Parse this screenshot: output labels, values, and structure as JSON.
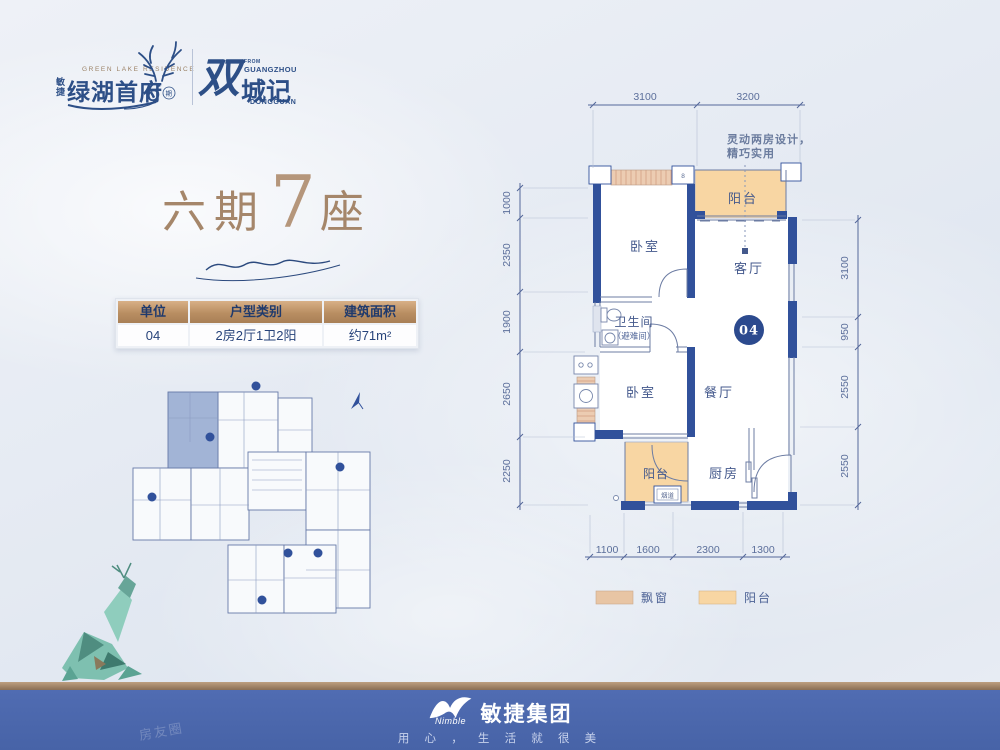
{
  "brand": {
    "company": "敏捷",
    "name": "绿湖首府",
    "name_en": "GREEN LAKE RESIDENCE",
    "phase_number": "6",
    "phase_unit": "期",
    "dual_char": "双",
    "dual_name": "城记",
    "from_label": "FROM",
    "city_top": "GUANGZHOU",
    "city_bottom": "DONGGUAN"
  },
  "title": {
    "phase": "六期",
    "number": "7",
    "unit": "座"
  },
  "spec_table": {
    "headers": [
      "单位",
      "户型类别",
      "建筑面积"
    ],
    "values": [
      "04",
      "2房2厅1卫2阳",
      "约71m²"
    ]
  },
  "callout": {
    "line1": "灵动两房设计，",
    "line2": "精巧实用"
  },
  "plan": {
    "badge": "04",
    "rooms": {
      "bedroom_top": "卧室",
      "bedroom_bottom": "卧室",
      "living": "客厅",
      "dining": "餐厅",
      "kitchen": "厨房",
      "bathroom": "卫生间",
      "bathroom_note": "（避难间）",
      "balcony_top": "阳台",
      "balcony_bottom": "阳台",
      "flue": "烟道",
      "column_label": "8"
    },
    "dims_top": [
      "3100",
      "3200"
    ],
    "dims_left": [
      "1000",
      "2350",
      "1900",
      "2650",
      "2250"
    ],
    "dims_right": [
      "3100",
      "950",
      "2550",
      "2550"
    ],
    "dims_bottom": [
      "1100",
      "1600",
      "2300",
      "1300"
    ]
  },
  "legend": {
    "bay_window": {
      "label": "飘窗",
      "color": "#e8c5a4"
    },
    "balcony": {
      "label": "阳台",
      "color": "#f8d6a3"
    }
  },
  "footer": {
    "logo_en": "Nimble",
    "logo_cn": "敏捷集团",
    "tagline": "用 心 ， 生 活 就 很 美"
  },
  "watermark": "房友圈"
}
